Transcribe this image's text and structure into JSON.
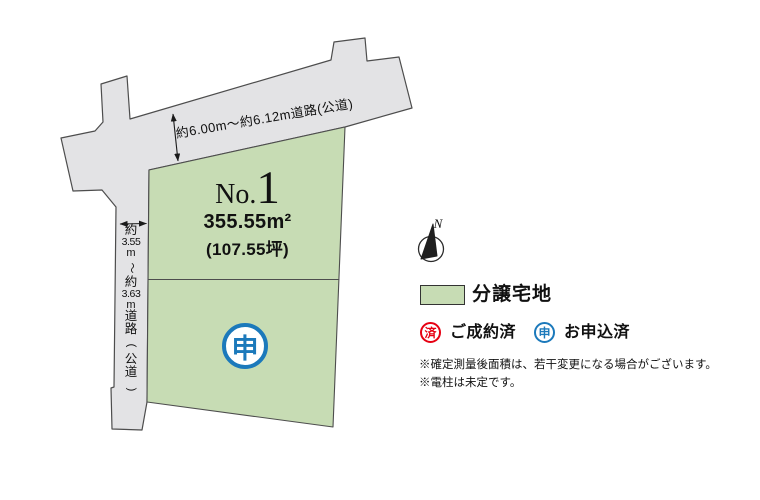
{
  "map": {
    "lot": {
      "no_prefix": "No.",
      "no_value": "1",
      "area_m2": "355.55m²",
      "area_tsubo": "(107.55坪)",
      "status_mark": "申"
    },
    "roads": {
      "top_label": "約6.00m〜約6.12m道路(公道)",
      "left_vertical": [
        "約",
        "3.55",
        "m",
        "〜",
        "約",
        "3.63",
        "m",
        "道",
        "路"
      ],
      "left_paren_open": "(",
      "left_paren_chars": [
        "公",
        "道"
      ],
      "left_paren_close": ")"
    },
    "compass_n": "N"
  },
  "legend": {
    "lot_swatch_label": "分譲宅地",
    "sold_mark": "済",
    "sold_label": "ご成約済",
    "applied_mark": "申",
    "applied_label": "お申込済"
  },
  "notes": [
    "※確定測量後面積は、若干変更になる場合がございます。",
    "※電柱は未定です。"
  ],
  "colors": {
    "lot_green": "#c7dcb4",
    "road_gray": "#e3e3e5",
    "applied_blue": "#1b79bb",
    "sold_red": "#e60012"
  }
}
